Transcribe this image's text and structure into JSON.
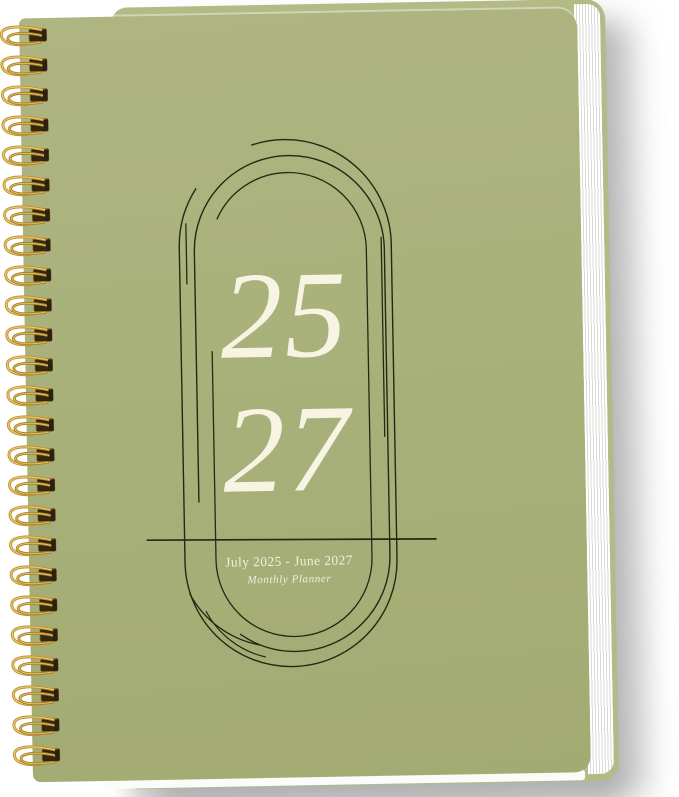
{
  "product": {
    "year_top": "25",
    "year_bottom": "27",
    "date_range": "July 2025 - June 2027",
    "subtitle": "Monthly Planner"
  },
  "cover": {
    "background_color": "#a9b17b",
    "back_cover_color": "#b3ba85",
    "line_art_color": "#222a14",
    "text_color": "#f7f4e4"
  },
  "binding": {
    "type": "gold wire-o spiral",
    "wire_color": "#bf9233",
    "slot_color": "#33270f",
    "loop_count": 25
  },
  "pages": {
    "edge_color": "#ffffff"
  }
}
